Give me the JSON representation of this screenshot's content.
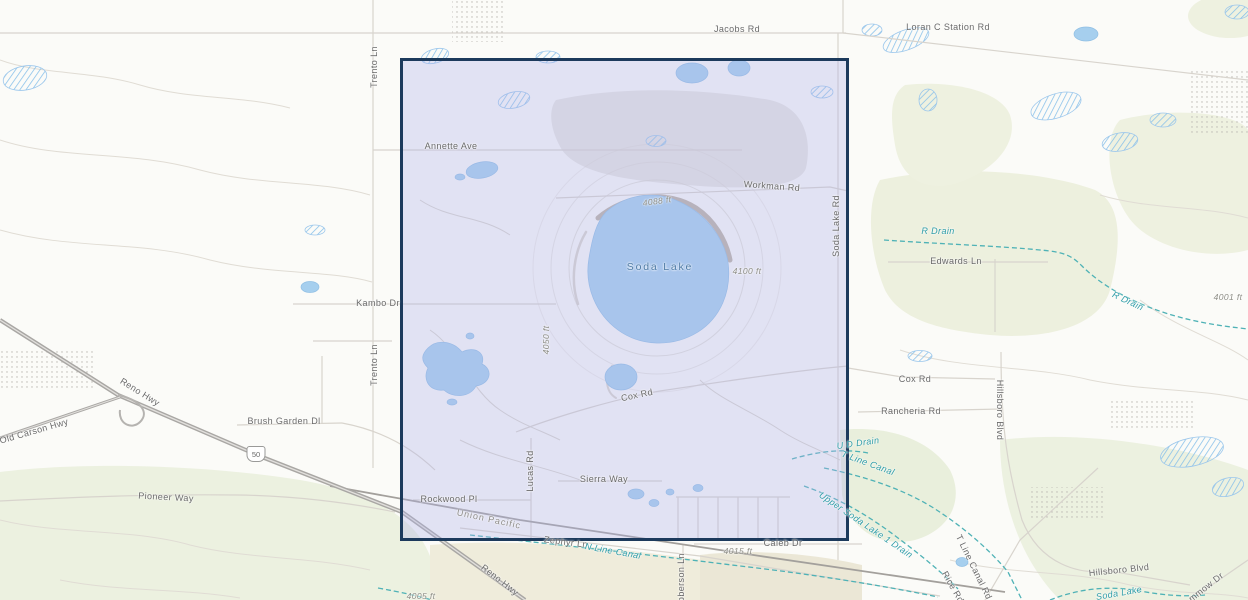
{
  "map": {
    "type": "topographic",
    "colors": {
      "selection_border": "#1c3a5c",
      "selection_fill": "rgba(172,177,233,0.33)",
      "water": "#a6cfee",
      "canal": "#2f9da8",
      "road_label": "#6a6a6a",
      "elevation_label": "#8d8d85",
      "lake_label": "#4e7ba6"
    },
    "route_shield": {
      "number": "50"
    },
    "labels": [
      {
        "text": "Jacobs Rd",
        "kind": "road"
      },
      {
        "text": "Loran C Station Rd",
        "kind": "road"
      },
      {
        "text": "Trento Ln",
        "kind": "road"
      },
      {
        "text": "Annette Ave",
        "kind": "road"
      },
      {
        "text": "Workman Rd",
        "kind": "road"
      },
      {
        "text": "4088 ft",
        "kind": "elevation"
      },
      {
        "text": "Soda Lake",
        "kind": "lake"
      },
      {
        "text": "4100 ft",
        "kind": "elevation"
      },
      {
        "text": "Soda Lake Rd",
        "kind": "road"
      },
      {
        "text": "R Drain",
        "kind": "canal"
      },
      {
        "text": "Edwards Ln",
        "kind": "road"
      },
      {
        "text": "4001 ft",
        "kind": "elevation"
      },
      {
        "text": "R Drain",
        "kind": "canal"
      },
      {
        "text": "Kambo Dr",
        "kind": "road"
      },
      {
        "text": "Trento Ln",
        "kind": "road"
      },
      {
        "text": "4050 ft",
        "kind": "elevation"
      },
      {
        "text": "Cox Rd",
        "kind": "road"
      },
      {
        "text": "Cox Rd",
        "kind": "road"
      },
      {
        "text": "Rancheria Rd",
        "kind": "road"
      },
      {
        "text": "Hillsboro Blvd",
        "kind": "road"
      },
      {
        "text": "Brush Garden Dl",
        "kind": "road"
      },
      {
        "text": "Old Carson Hwy",
        "kind": "road"
      },
      {
        "text": "Reno Hwy",
        "kind": "road"
      },
      {
        "text": "Pioneer Way",
        "kind": "road"
      },
      {
        "text": "U D Drain",
        "kind": "canal"
      },
      {
        "text": "T Line Canal",
        "kind": "canal"
      },
      {
        "text": "Rockwood Pl",
        "kind": "road"
      },
      {
        "text": "Lucas Rd",
        "kind": "road"
      },
      {
        "text": "Sierra Way",
        "kind": "road"
      },
      {
        "text": "Union Pacific",
        "kind": "railroad"
      },
      {
        "text": "Zephyr Ln",
        "kind": "road"
      },
      {
        "text": "N Line Canal",
        "kind": "canal"
      },
      {
        "text": "Upper Soda Lake 1 Drain",
        "kind": "canal"
      },
      {
        "text": "Caleb Dr",
        "kind": "road"
      },
      {
        "text": "4015 ft",
        "kind": "elevation"
      },
      {
        "text": "Roberson Ln",
        "kind": "road"
      },
      {
        "text": "Reno Hwy",
        "kind": "road"
      },
      {
        "text": "T Line Canal Rd",
        "kind": "road"
      },
      {
        "text": "Rice Rd",
        "kind": "road"
      },
      {
        "text": "Hillsboro Blvd",
        "kind": "road"
      },
      {
        "text": "Soda Lake",
        "kind": "canal"
      },
      {
        "text": "mmow Dr",
        "kind": "road"
      },
      {
        "text": "4005 ft",
        "kind": "elevation"
      }
    ]
  }
}
